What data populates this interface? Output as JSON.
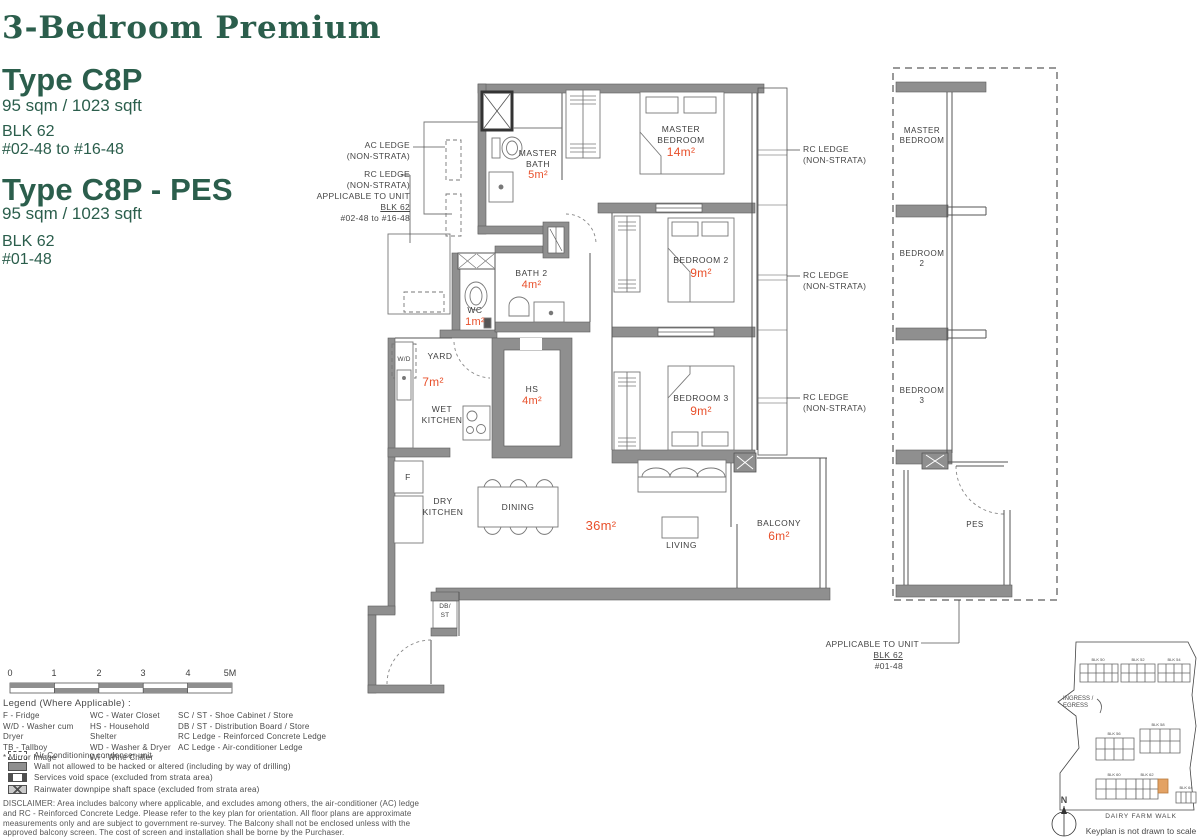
{
  "page": {
    "title": "3-Bedroom Premium"
  },
  "types": [
    {
      "name": "Type C8P",
      "area": "95 sqm / 1023 sqft",
      "blk": "BLK 62",
      "units": "#02-48 to #16-48"
    },
    {
      "name": "Type C8P - PES",
      "area": "95 sqm / 1023 sqft",
      "blk": "BLK 62",
      "units": "#01-48"
    }
  ],
  "colors": {
    "accent_green": "#2b5e4c",
    "area_red": "#e8502b",
    "wall_gray": "#8f8f8f",
    "keyplan_highlight": "#e3a264"
  },
  "floorplan": {
    "rooms": {
      "master_bedroom": {
        "label": "MASTER BEDROOM",
        "area": "14m²"
      },
      "master_bath": {
        "label": "MASTER BATH",
        "area": "5m²"
      },
      "bedroom2": {
        "label": "BEDROOM 2",
        "area": "9m²"
      },
      "bedroom3": {
        "label": "BEDROOM 3",
        "area": "9m²"
      },
      "bath2": {
        "label": "BATH 2",
        "area": "4m²"
      },
      "wc": {
        "label": "WC",
        "area": "1m²"
      },
      "yard": {
        "label": "YARD",
        "area": "7m²"
      },
      "hs": {
        "label": "HS",
        "area": "4m²"
      },
      "wet_kitchen": {
        "label": "WET KITCHEN"
      },
      "dry_kitchen": {
        "label": "DRY KITCHEN"
      },
      "dining": {
        "label": "DINING"
      },
      "living": {
        "label": "LIVING",
        "area": "36m²"
      },
      "balcony": {
        "label": "BALCONY",
        "area": "6m²"
      },
      "wd": {
        "label": "W/D"
      },
      "fridge": {
        "label": "F"
      },
      "dbst": {
        "label": "DB/",
        "label2": "ST"
      }
    },
    "callouts": {
      "ac_ledge": {
        "line1": "AC LEDGE",
        "line2": "(NON-STRATA)"
      },
      "rc_ledge_left": {
        "line1": "RC LEDGE",
        "line2": "(NON-STRATA)",
        "line3": "APPLICABLE TO UNIT",
        "line4": "BLK 62",
        "line5": "#02-48 to #16-48"
      },
      "rc_ledge_right": {
        "line1": "RC LEDGE",
        "line2": "(NON-STRATA)"
      },
      "pes_applicable": {
        "line1": "APPLICABLE TO UNIT",
        "line2": "BLK 62",
        "line3": "#01-48"
      }
    },
    "pes_panel": {
      "master_bedroom": "MASTER BEDROOM",
      "bedroom2": "BEDROOM 2",
      "bedroom3": "BEDROOM 3",
      "pes": "PES"
    }
  },
  "scalebar": {
    "labels": [
      "0",
      "1",
      "2",
      "3",
      "4",
      "5M"
    ]
  },
  "legend": {
    "heading": "Legend (Where Applicable) :",
    "col1": [
      "F - Fridge",
      "W/D - Washer cum Dryer",
      "TB - Tallboy",
      "* Mirror Image"
    ],
    "col2": [
      "WC - Water Closet",
      "HS - Household Shelter",
      "WD - Washer & Dryer",
      "WI - Wine Chiller"
    ],
    "col3": [
      "SC / ST - Shoe Cabinet / Store",
      "DB / ST - Distribution Board / Store",
      "RC Ledge - Reinforced Concrete Ledge",
      "AC Ledge - Air-conditioner Ledge"
    ],
    "symbols": [
      {
        "icon": "ac-condenser-symbol",
        "label": "Air-Conditioning condenser unit"
      },
      {
        "icon": "wall-symbol",
        "label": "Wall not allowed to be hacked or altered (including by way of drilling)"
      },
      {
        "icon": "services-void-symbol",
        "label": "Services void space (excluded from strata area)"
      },
      {
        "icon": "rainwater-symbol",
        "label": "Rainwater downpipe shaft space (excluded from strata area)"
      }
    ]
  },
  "disclaimer": "DISCLAIMER: Area includes balcony where applicable, and excludes among others, the air-conditioner (AC) ledge and RC - Reinforced Concrete Ledge. Please refer to the key plan for orientation. All floor plans are approximate measurements only and are subject to government re-survey. The Balcony shall not be enclosed unless with the approved balcony screen. The cost of screen and installation shall be borne by the Purchaser.",
  "keyplan": {
    "blocks": [
      "BLK 50",
      "BLK 52",
      "BLK 54",
      "BLK 56",
      "BLK 58",
      "BLK 60",
      "BLK 62",
      "BLK 64"
    ],
    "ingress": "INGRESS /",
    "egress": "EGRESS",
    "road": "DAIRY FARM WALK",
    "note": "Keyplan is not drawn to scale",
    "north": "N"
  }
}
